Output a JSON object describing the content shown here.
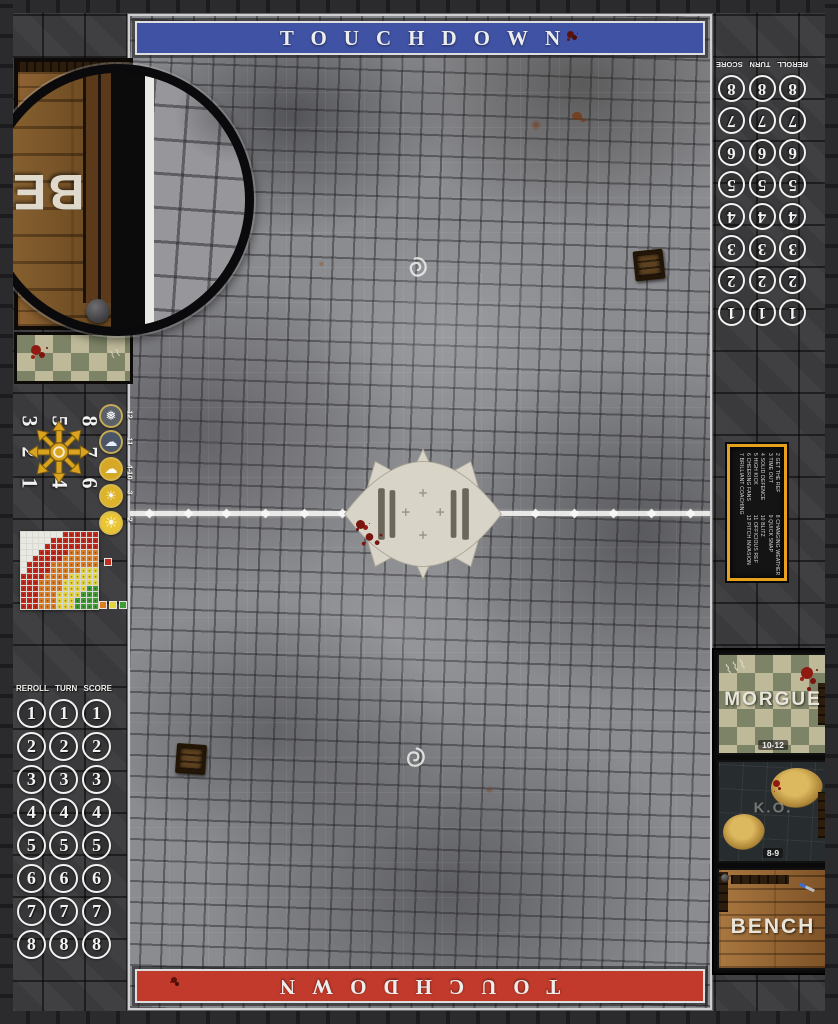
{
  "mat": {
    "touchdown_top": "TOUCHDOWN",
    "touchdown_bottom": "TOUCHDOWN",
    "banner_top_color": "#3f52a3",
    "banner_bottom_color": "#c13a2b",
    "midline_diamonds": 15
  },
  "tracks": {
    "header": [
      "REROLL",
      "TURN",
      "SCORE"
    ],
    "numbers": [
      "1",
      "2",
      "3",
      "4",
      "5",
      "6",
      "7",
      "8"
    ],
    "columns": 3
  },
  "scatter_template": {
    "layout": [
      [
        "3",
        "5",
        "8"
      ],
      [
        "2",
        "",
        "7"
      ],
      [
        "1",
        "4",
        "6"
      ]
    ],
    "star_color": "#d9a31f"
  },
  "weather_table": {
    "rows": [
      {
        "icon": "blizzard",
        "glyph": "❅",
        "label": "12"
      },
      {
        "icon": "rain",
        "glyph": "☁",
        "label": "11"
      },
      {
        "icon": "partly",
        "glyph": "☁",
        "label": "4-10"
      },
      {
        "icon": "sunny",
        "glyph": "☀",
        "label": "3"
      },
      {
        "icon": "sweltering",
        "glyph": "☀",
        "label": "2"
      }
    ]
  },
  "range_ruler": {
    "grid": 13,
    "bands": [
      {
        "name": "quick-pass",
        "color": "#3e9b35",
        "max": 3.6
      },
      {
        "name": "short-pass",
        "color": "#e3d33c",
        "max": 6.6
      },
      {
        "name": "long-pass",
        "color": "#dd7d23",
        "max": 9.9
      },
      {
        "name": "long-bomb",
        "color": "#c22b20",
        "max": 13.4
      }
    ],
    "empty_color": "#e9e9e4",
    "legend_single": "#c22b20",
    "legend_row": [
      "#dd7d23",
      "#e3d33c",
      "#3e9b35"
    ]
  },
  "kickoff_table": {
    "border_color": "#e8a11c",
    "entries": [
      "2 GET THE REF",
      "3 TIME OUT",
      "4 SOLID DEFENCE",
      "5 HIGH KICK",
      "6 CHEERING FANS",
      "7 BRILLIANT COACHING",
      "8 CHANGING WEATHER",
      "9 QUICK SNAP",
      "10 BLITZ",
      "11 OFFICIOUS REF",
      "12 PITCH INVASION"
    ]
  },
  "dugout_right": {
    "morgue": {
      "label": "MORGUE",
      "dice": "10-12"
    },
    "ko": {
      "label": "K.O.",
      "dice": "8-9"
    },
    "bench": {
      "label": "BENCH"
    }
  },
  "dugout_left": {
    "bench_label": "BENCH",
    "magnifier_visible_letters": "BE"
  }
}
